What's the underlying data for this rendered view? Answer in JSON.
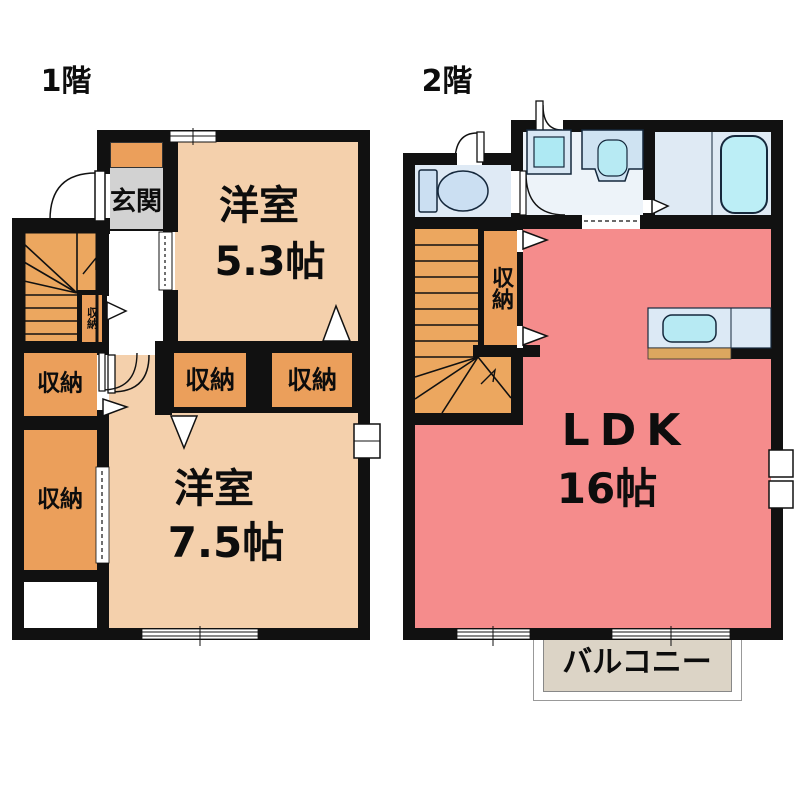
{
  "title": "2-story floor plan",
  "colors": {
    "wall": "#111111",
    "room_peach": "#F4D0AC",
    "ldk_pink": "#F58C8C",
    "storage_orange": "#EB9F5B",
    "stairs_orange": "#ECA75F",
    "entrance_gray": "#D2D2D2",
    "fixture_blue": "#DCE9F5",
    "water_cyan": "#AEE9F3",
    "balcony_beige": "#DCD4C6"
  },
  "floor1": {
    "label": "1階",
    "entrance": "玄関",
    "room_5_3": {
      "name": "洋室",
      "size": "5.3帖"
    },
    "room_7_5": {
      "name": "洋室",
      "size": "7.5帖"
    },
    "closets": {
      "upper_left": "収納",
      "lower_left": "収納",
      "stair_small": "収納",
      "room_top_left": "収納",
      "room_top_right": "収納"
    }
  },
  "floor2": {
    "label": "2階",
    "closet": "収納",
    "ldk": {
      "name": "LDK",
      "size": "16帖"
    },
    "balcony": "バルコニー"
  }
}
